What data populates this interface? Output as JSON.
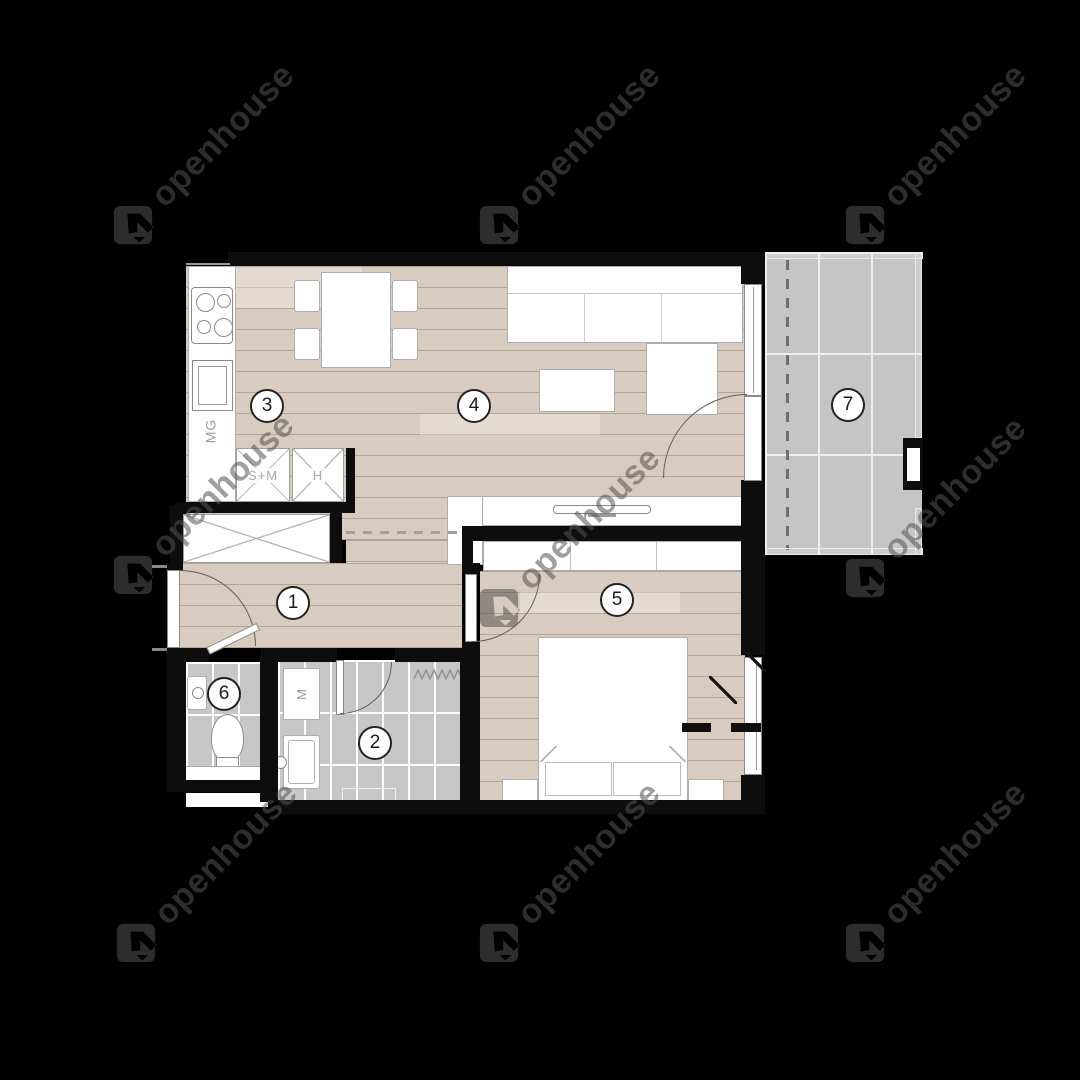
{
  "watermark": {
    "text": "openhouse"
  },
  "rooms": [
    {
      "number": "1"
    },
    {
      "number": "2"
    },
    {
      "number": "3"
    },
    {
      "number": "4"
    },
    {
      "number": "5"
    },
    {
      "number": "6"
    },
    {
      "number": "7"
    }
  ],
  "labels": {
    "microwave": "MG",
    "wardrobe_sm": "S+M",
    "wardrobe_h": "H",
    "washing_machine": "M"
  },
  "colors": {
    "background": "#000000",
    "floor_wood": "#d7ccbf",
    "floor_tile": "#c7c7c7",
    "wall": "#0d0d0d",
    "watermark_gray": "#2d2d2d"
  }
}
